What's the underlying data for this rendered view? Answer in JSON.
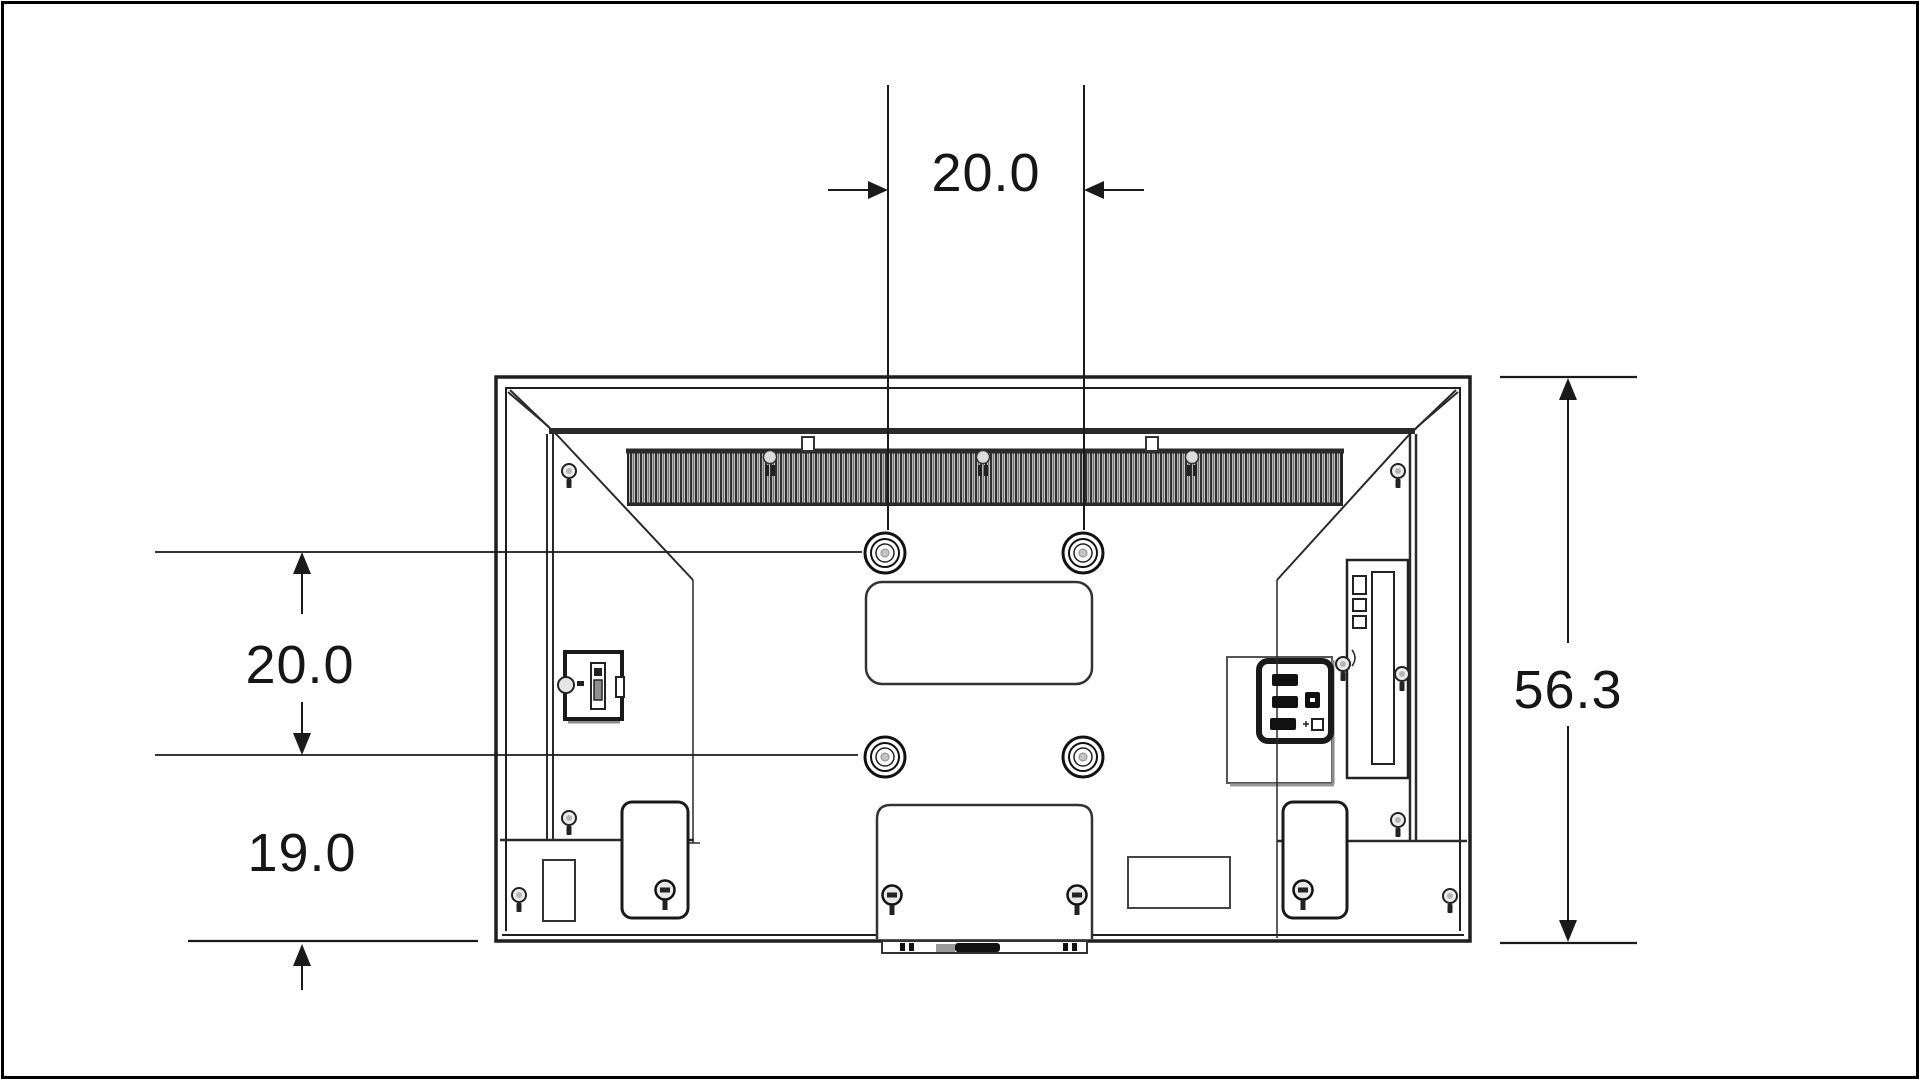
{
  "figure": {
    "description": "Rear-view technical line drawing of a flat-panel TV showing VESA wall-mount hole spacing",
    "background_color": "#ffffff",
    "line_color": "#1f1f1f"
  },
  "dimensions": {
    "hole_spacing_horizontal": "20.0",
    "hole_spacing_vertical": "20.0",
    "bottom_hole_to_bottom_edge": "19.0",
    "overall_height": "56.3"
  }
}
